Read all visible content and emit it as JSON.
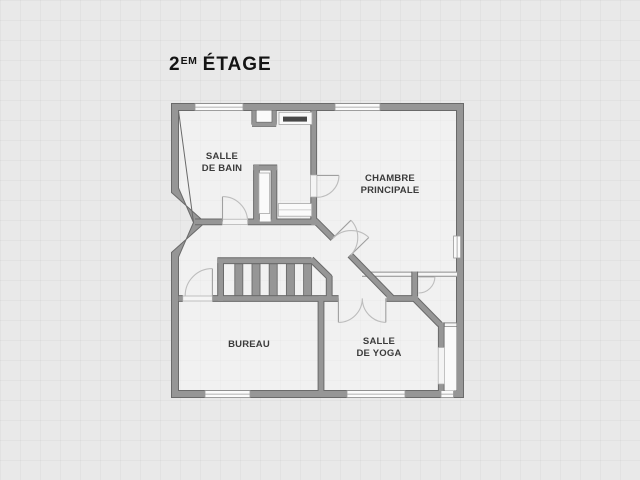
{
  "title": {
    "number": "2",
    "superscript": "EM",
    "rest": "ÉTAGE"
  },
  "rooms": {
    "bathroom": {
      "line1": "SALLE",
      "line2": "DE BAIN"
    },
    "master_bedroom": {
      "line1": "CHAMBRE",
      "line2": "PRINCIPALE"
    },
    "office": {
      "line1": "BUREAU"
    },
    "yoga": {
      "line1": "SALLE",
      "line2": "DE YOGA"
    }
  },
  "colors": {
    "background": "#e9e9e9",
    "wall": "#969696",
    "wall_edge": "#6a6a6a",
    "window": "#fbfbfb",
    "door_arc": "#bdbdbd",
    "label": "#3b3b3b",
    "title": "#141414"
  }
}
